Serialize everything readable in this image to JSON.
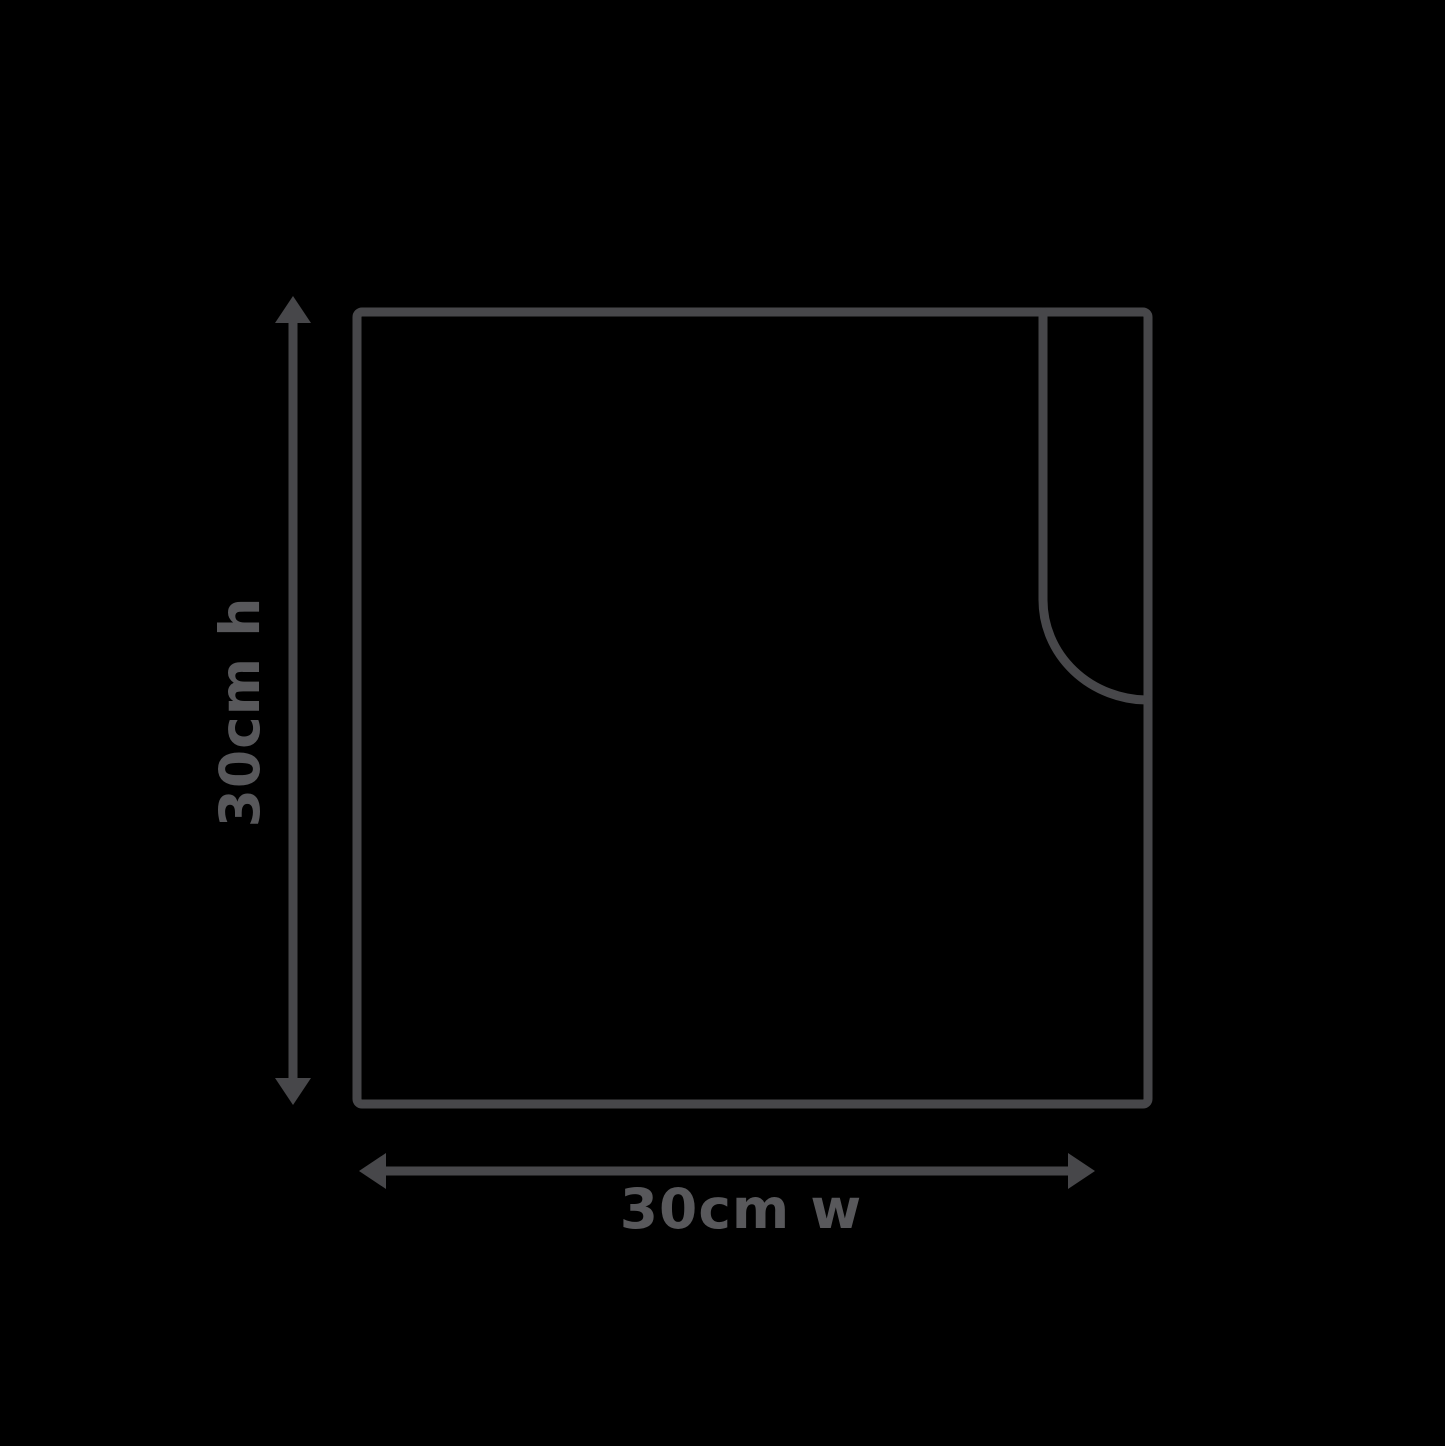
{
  "diagram": {
    "title": "square item dimension diagram",
    "height_label": "30cm h",
    "width_label": "30cm w",
    "colors": {
      "background": "#000000",
      "outline": "#47474a",
      "arrow": "#47474a",
      "label_text": "#58585b"
    },
    "icons": {
      "height_arrow": "double-headed-vertical-arrow-icon",
      "width_arrow": "double-headed-horizontal-arrow-icon"
    }
  }
}
